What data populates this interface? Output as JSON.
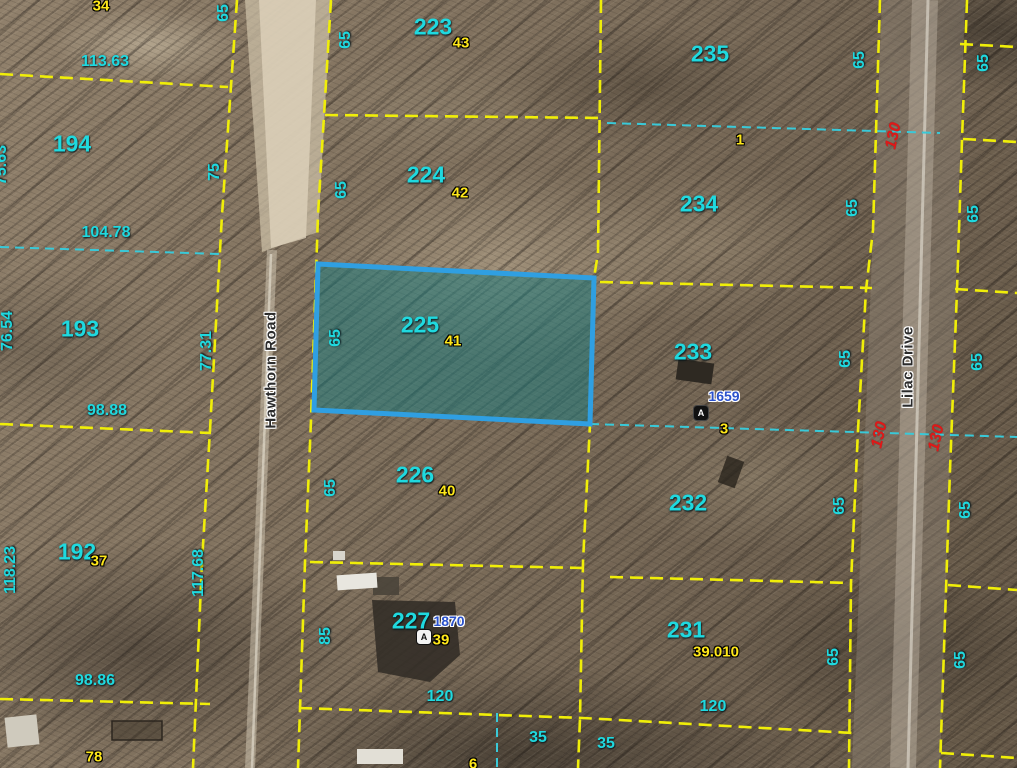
{
  "title": "Aerial parcel map",
  "colors": {
    "parcel_line": "#f0ee08",
    "lot_line": "#39c9d8",
    "parcel_number": "#1fd9df",
    "lot_number": "#ffe81a",
    "road_frontage_red": "#e01818",
    "address_blue": "#2b52cc",
    "selected_border": "#2f9fe2",
    "selected_fill": "rgba(23,125,130,0.5)"
  },
  "roads": {
    "hawthorn": "Hawthorn Road",
    "lilac": "Lilac Drive"
  },
  "selected_parcel": {
    "number": "225",
    "lot": "41"
  },
  "parcels": {
    "p34": {
      "lot": "34"
    },
    "p194": {
      "number": "194"
    },
    "p193": {
      "number": "193"
    },
    "p192": {
      "number": "192",
      "lot": "37"
    },
    "p78": {
      "lot": "78"
    },
    "p223": {
      "number": "223",
      "lot": "43"
    },
    "p224": {
      "number": "224",
      "lot": "42"
    },
    "p226": {
      "number": "226",
      "lot": "40"
    },
    "p227": {
      "number": "227",
      "lot": "39",
      "address": "1870",
      "marker": "A"
    },
    "p6": {
      "lot": "6"
    },
    "p235": {
      "number": "235",
      "lot": "1"
    },
    "p234": {
      "number": "234"
    },
    "p233": {
      "number": "233",
      "lot": "3",
      "address": "1659",
      "marker": "A"
    },
    "p232": {
      "number": "232"
    },
    "p231": {
      "number": "231",
      "lot": "39.010"
    }
  },
  "dimensions": {
    "w113_63": "113.63",
    "w104_78": "104.78",
    "w98_88": "98.88",
    "w98_86": "98.86",
    "d75_63": "75.63",
    "d76_54": "76.54",
    "d118_23": "118.23",
    "d75": "75",
    "d77_31": "77.31",
    "d117_68": "117.68",
    "d65": "65",
    "d85": "85",
    "d130": "130",
    "w120": "120",
    "w35": "35"
  }
}
